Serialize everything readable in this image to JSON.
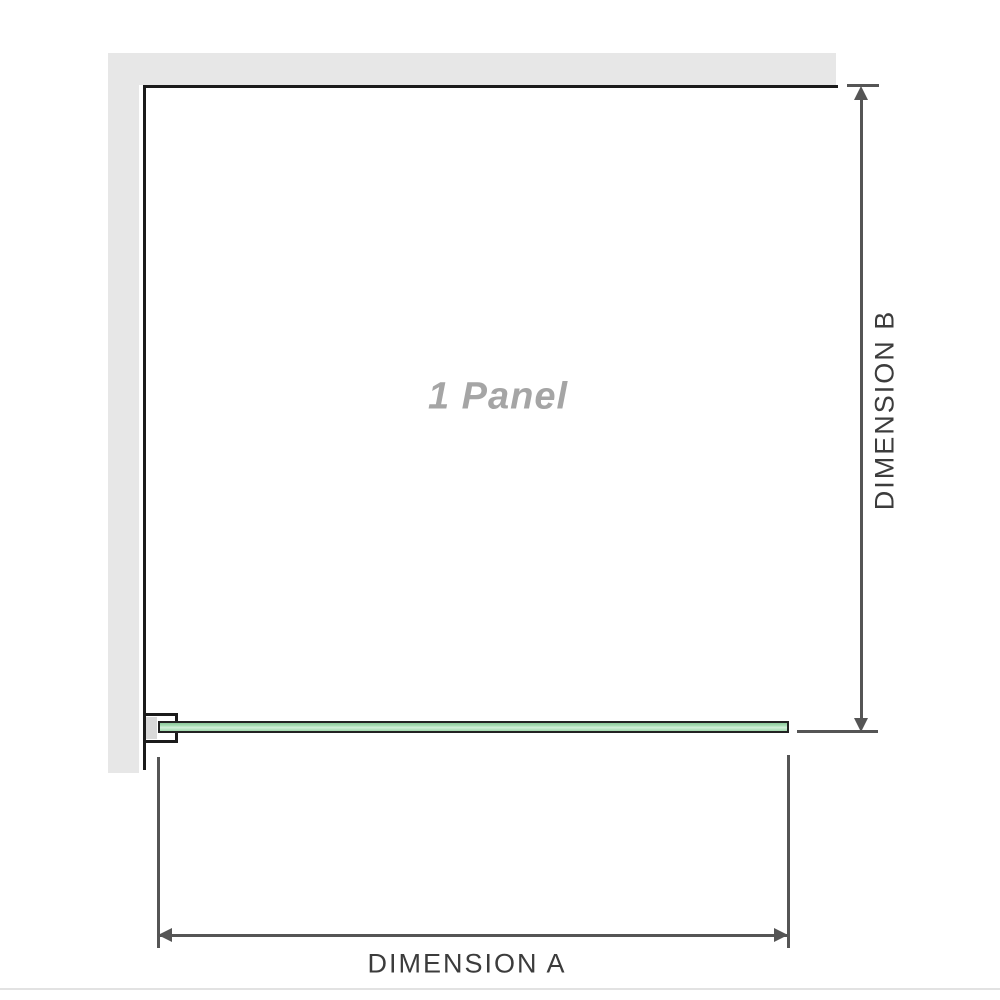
{
  "diagram": {
    "panel_label": "1 Panel",
    "dimension_a_label": "DIMENSION A",
    "dimension_b_label": "DIMENSION B"
  },
  "colors": {
    "wall_gray": "#e7e7e7",
    "outline_black": "#1b1b1b",
    "glass_green": "#a0d8ac",
    "glass_border": "#222222",
    "dimension_gray": "#555555",
    "label_gray": "#a5a5a5",
    "text_dark": "#3c3c3c"
  }
}
